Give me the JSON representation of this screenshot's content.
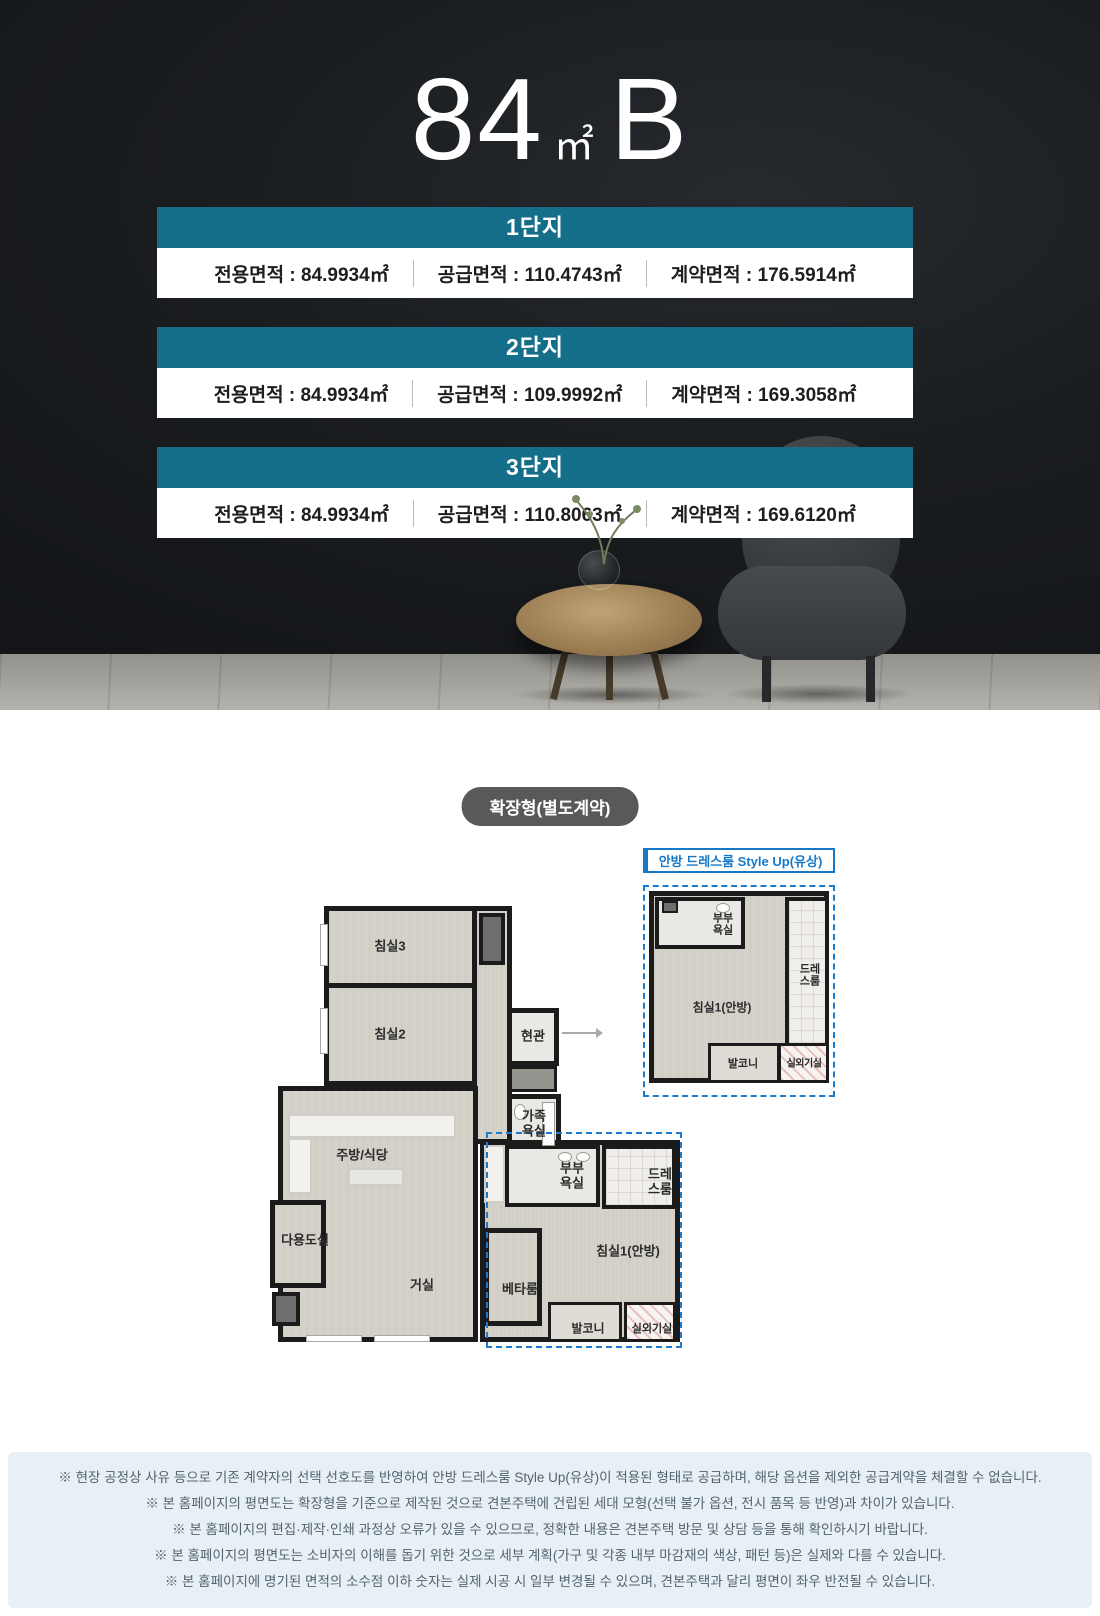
{
  "hero": {
    "title_number": "84",
    "title_unit": "㎡",
    "title_suffix": "B",
    "complexes": [
      {
        "name": "1단지",
        "specs": [
          "전용면적 : 84.9934㎡",
          "공급면적 : 110.4743㎡",
          "계약면적 : 176.5914㎡"
        ]
      },
      {
        "name": "2단지",
        "specs": [
          "전용면적 : 84.9934㎡",
          "공급면적 : 109.9992㎡",
          "계약면적 : 169.3058㎡"
        ]
      },
      {
        "name": "3단지",
        "specs": [
          "전용면적 : 84.9934㎡",
          "공급면적 : 110.8063㎡",
          "계약면적 : 169.6120㎡"
        ]
      }
    ]
  },
  "floorplan": {
    "badge": "확장형(별도계약)",
    "styleup_title": "안방 드레스룸 Style Up(유상)",
    "rooms": {
      "bedroom3": "침실3",
      "bedroom2": "침실2",
      "entrance": "현관",
      "family_bath": "가족욕실",
      "kitchen": "주방/식당",
      "utility": "다용도실",
      "living": "거실",
      "master_bath": "부부욕실",
      "dressroom": "드레스룸",
      "master_bedroom": "침실1(안방)",
      "beta_room": "베타룸",
      "balcony": "발코니",
      "outdoor_unit": "실외기실"
    },
    "styleup_rooms": {
      "master_bath": "부부욕실",
      "dressroom": "드레스룸",
      "master_bedroom": "침실1(안방)",
      "balcony": "발코니",
      "outdoor_unit": "실외기실"
    }
  },
  "footer": {
    "notes": [
      "※ 현장 공정상 사유 등으로 기존 계약자의 선택 선호도를 반영하여 안방 드레스룸 Style Up(유상)이 적용된 형태로 공급하며, 해당 옵션을 제외한 공급계약을 체결할 수 없습니다.",
      "※ 본 홈페이지의 평면도는 확장형을 기준으로 제작된 것으로 견본주택에 건립된 세대 모형(선택 불가 옵션, 전시 품목 등 반영)과 차이가 있습니다.",
      "※ 본 홈페이지의 편집·제작·인쇄 과정상 오류가 있을 수 있으므로, 정확한 내용은 견본주택 방문 및 상담 등을 통해 확인하시기 바랍니다.",
      "※ 본 홈페이지의 평면도는 소비자의 이해를 돕기 위한 것으로 세부 계획(가구 및 각종 내부 마감재의 색상, 패턴 등)은 실제와 다를 수 있습니다.",
      "※ 본 홈페이지에 명기된 면적의 소수점 이하 숫자는 실제 시공 시 일부 변경될 수 있으며, 견본주택과 달리 평면이 좌우 반전될 수 있습니다."
    ]
  },
  "colors": {
    "header_teal": "#146E8A",
    "badge_gray": "#58595B",
    "styleup_blue": "#1778C8",
    "dashed_blue": "#1A7BD0",
    "footer_bg": "#E7F0F6",
    "hero_bg": "#17191C"
  }
}
